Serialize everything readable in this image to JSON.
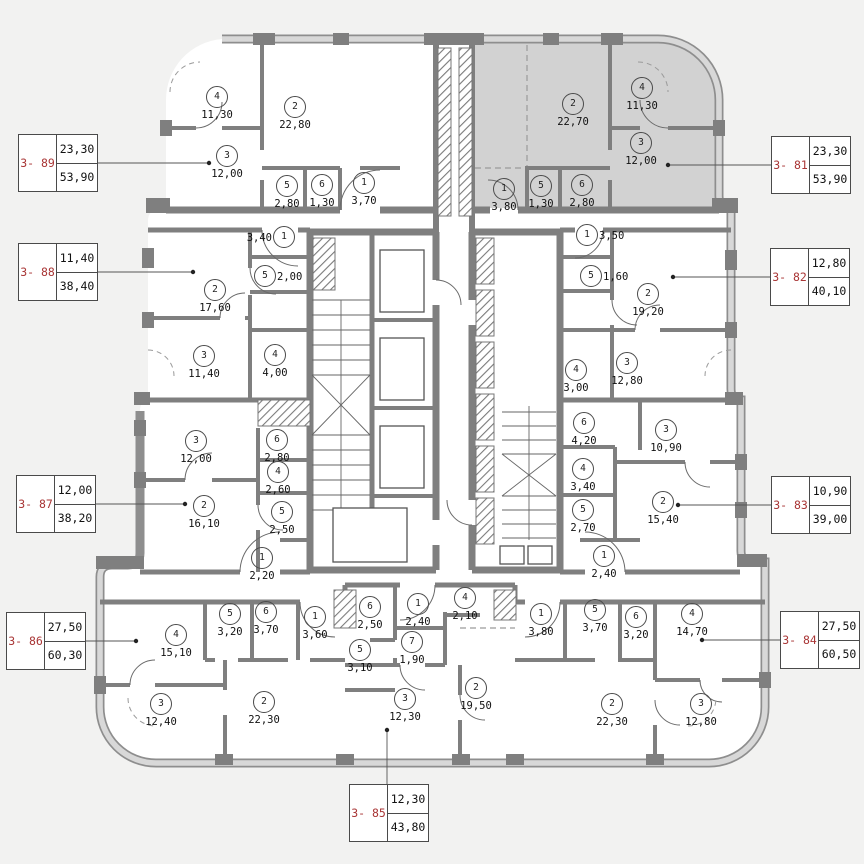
{
  "colors": {
    "wall": "#7f7f7f",
    "wall_band": "#8e8e8e",
    "band_fill": "#d8d8d8",
    "shaded_apartment": "#d2d2d2",
    "callout_red": "#a93636",
    "paper": "#f2f2f1"
  },
  "apartments": [
    {
      "id": "3- 89",
      "callout": {
        "a1": "23,30",
        "a2": "53,90"
      },
      "rooms": [
        {
          "n": "4",
          "a": "11,30"
        },
        {
          "n": "2",
          "a": "22,80"
        },
        {
          "n": "3",
          "a": "12,00"
        },
        {
          "n": "5",
          "a": "2,80"
        },
        {
          "n": "6",
          "a": "1,30"
        },
        {
          "n": "1",
          "a": "3,70"
        }
      ]
    },
    {
      "id": "3- 81",
      "callout": {
        "a1": "23,30",
        "a2": "53,90"
      },
      "rooms": [
        {
          "n": "2",
          "a": "22,70"
        },
        {
          "n": "4",
          "a": "11,30"
        },
        {
          "n": "3",
          "a": "12,00"
        },
        {
          "n": "1",
          "a": "3,80"
        },
        {
          "n": "5",
          "a": "1,30"
        },
        {
          "n": "6",
          "a": "2,80"
        }
      ]
    },
    {
      "id": "3- 88",
      "callout": {
        "a1": "11,40",
        "a2": "38,40"
      },
      "rooms": [
        {
          "n": "1",
          "a": "3,40"
        },
        {
          "n": "5",
          "a": "2,00"
        },
        {
          "n": "2",
          "a": "17,60"
        },
        {
          "n": "3",
          "a": "11,40"
        },
        {
          "n": "4",
          "a": "4,00"
        }
      ]
    },
    {
      "id": "3- 82",
      "callout": {
        "a1": "12,80",
        "a2": "40,10"
      },
      "rooms": [
        {
          "n": "1",
          "a": "3,50"
        },
        {
          "n": "5",
          "a": "1,60"
        },
        {
          "n": "2",
          "a": "19,20"
        },
        {
          "n": "4",
          "a": "3,00"
        },
        {
          "n": "3",
          "a": "12,80"
        }
      ]
    },
    {
      "id": "3- 87",
      "callout": {
        "a1": "12,00",
        "a2": "38,20"
      },
      "rooms": [
        {
          "n": "3",
          "a": "12,00"
        },
        {
          "n": "6",
          "a": "2,80"
        },
        {
          "n": "4",
          "a": "2,60"
        },
        {
          "n": "2",
          "a": "16,10"
        },
        {
          "n": "5",
          "a": "2,50"
        },
        {
          "n": "1",
          "a": "2,20"
        }
      ]
    },
    {
      "id": "3- 83",
      "callout": {
        "a1": "10,90",
        "a2": "39,00"
      },
      "rooms": [
        {
          "n": "6",
          "a": "4,20"
        },
        {
          "n": "3",
          "a": "10,90"
        },
        {
          "n": "4",
          "a": "3,40"
        },
        {
          "n": "5",
          "a": "2,70"
        },
        {
          "n": "2",
          "a": "15,40"
        },
        {
          "n": "1",
          "a": "2,40"
        }
      ]
    },
    {
      "id": "3- 86",
      "callout": {
        "a1": "27,50",
        "a2": "60,30"
      },
      "rooms": [
        {
          "n": "4",
          "a": "15,10"
        },
        {
          "n": "5",
          "a": "3,20"
        },
        {
          "n": "6",
          "a": "3,70"
        },
        {
          "n": "1",
          "a": "3,60"
        },
        {
          "n": "3",
          "a": "12,40"
        },
        {
          "n": "2",
          "a": "22,30"
        }
      ]
    },
    {
      "id": "3- 85",
      "callout": {
        "a1": "12,30",
        "a2": "43,80"
      },
      "rooms": [
        {
          "n": "6",
          "a": "2,50"
        },
        {
          "n": "1",
          "a": "2,40"
        },
        {
          "n": "4",
          "a": "2,10"
        },
        {
          "n": "7",
          "a": "1,90"
        },
        {
          "n": "5",
          "a": "3,10"
        },
        {
          "n": "3",
          "a": "12,30"
        },
        {
          "n": "2",
          "a": "19,50"
        }
      ]
    },
    {
      "id": "3- 84",
      "callout": {
        "a1": "27,50",
        "a2": "60,50"
      },
      "rooms": [
        {
          "n": "1",
          "a": "3,80"
        },
        {
          "n": "5",
          "a": "3,70"
        },
        {
          "n": "6",
          "a": "3,20"
        },
        {
          "n": "4",
          "a": "14,70"
        },
        {
          "n": "2",
          "a": "22,30"
        },
        {
          "n": "3",
          "a": "12,80"
        }
      ]
    }
  ]
}
